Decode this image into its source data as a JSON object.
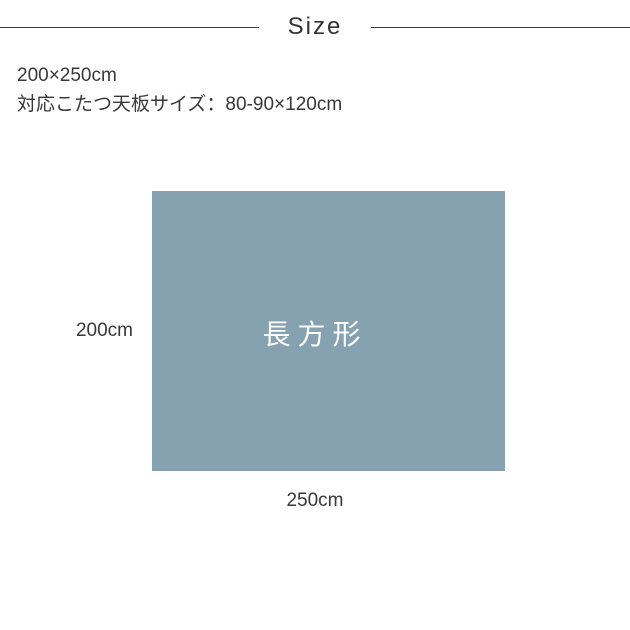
{
  "header": {
    "title": "Size"
  },
  "specs": {
    "size": "200×250cm",
    "compatible": "対応こたつ天板サイズ：80-90×120cm"
  },
  "diagram": {
    "shape_label": "長方形",
    "height_label": "200cm",
    "width_label": "250cm",
    "rect_color": "#86a2b0",
    "shape_label_color": "#ffffff"
  },
  "colors": {
    "text": "#383838",
    "rule": "#3c3c3c",
    "background": "#ffffff"
  }
}
